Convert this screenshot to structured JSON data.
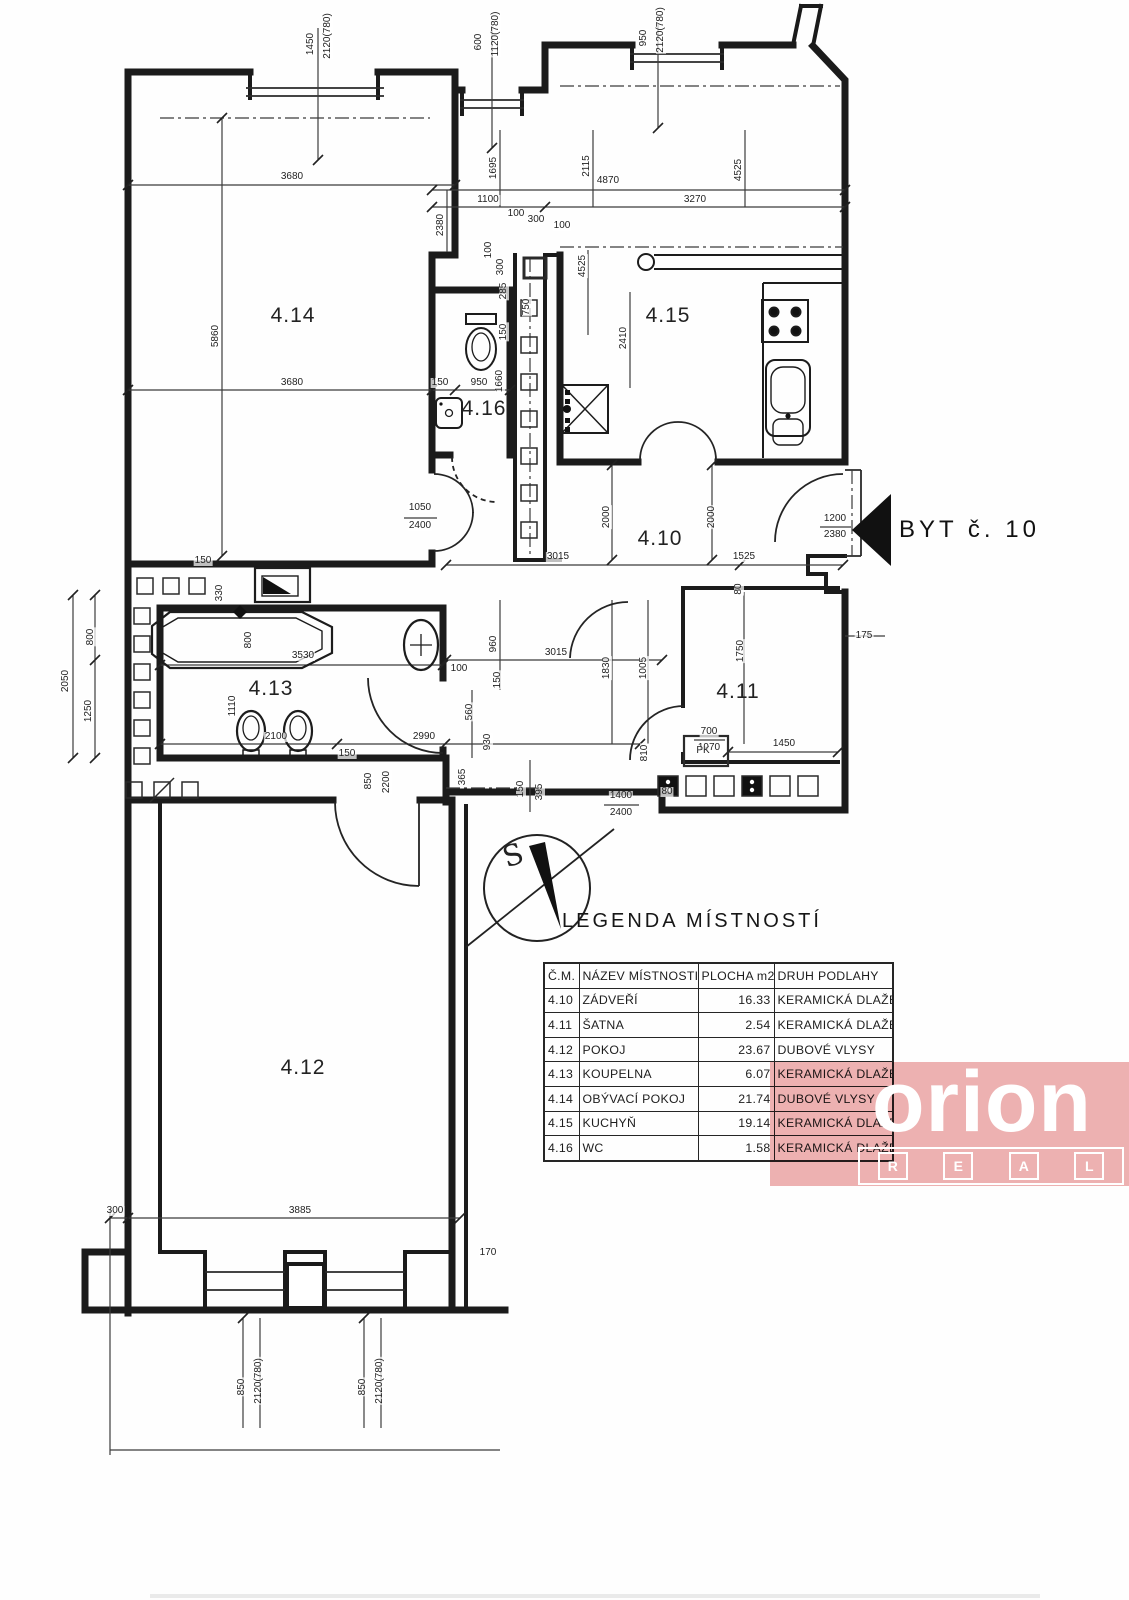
{
  "entrance": {
    "label": "BYT č. 10",
    "door_dims": "1200/2380"
  },
  "compass": {
    "north_letter": "S"
  },
  "legend": {
    "title": "LEGENDA MÍSTNOSTÍ",
    "headers": [
      "Č.M.",
      "NÁZEV MÍSTNOSTI",
      "PLOCHA m2",
      "DRUH PODLAHY"
    ],
    "rows": [
      [
        "4.10",
        "ZÁDVEŘÍ",
        "16.33",
        "KERAMICKÁ DLAŽBA"
      ],
      [
        "4.11",
        "ŠATNA",
        "2.54",
        "KERAMICKÁ DLAŽBA"
      ],
      [
        "4.12",
        "POKOJ",
        "23.67",
        "DUBOVÉ VLYSY"
      ],
      [
        "4.13",
        "KOUPELNA",
        "6.07",
        "KERAMICKÁ DLAŽBA"
      ],
      [
        "4.14",
        "OBÝVACÍ POKOJ",
        "21.74",
        "DUBOVÉ VLYSY"
      ],
      [
        "4.15",
        "KUCHYŇ",
        "19.14",
        "KERAMICKÁ DLAŽBA"
      ],
      [
        "4.16",
        "WC",
        "1.58",
        "KERAMICKÁ DLAŽBA"
      ]
    ]
  },
  "watermark": {
    "brand": "orion",
    "sub_letters": [
      "R",
      "E",
      "A",
      "L"
    ],
    "color": "#eeb2b2"
  },
  "plan": {
    "rooms": [
      {
        "id": "4.14",
        "x": 293,
        "y": 316
      },
      {
        "id": "4.15",
        "x": 668,
        "y": 316
      },
      {
        "id": "4.16",
        "x": 484,
        "y": 409
      },
      {
        "id": "4.10",
        "x": 660,
        "y": 539
      },
      {
        "id": "4.11",
        "x": 738,
        "y": 692
      },
      {
        "id": "4.13",
        "x": 271,
        "y": 689
      },
      {
        "id": "4.12",
        "x": 303,
        "y": 1068
      }
    ],
    "dimensions": [
      {
        "t": "1450",
        "x": 311,
        "y": 44,
        "r": 1
      },
      {
        "t": "2120(780)",
        "x": 328,
        "y": 36,
        "r": 1
      },
      {
        "t": "600",
        "x": 479,
        "y": 42,
        "r": 1
      },
      {
        "t": "1120(780)",
        "x": 496,
        "y": 34,
        "r": 1
      },
      {
        "t": "950",
        "x": 644,
        "y": 38,
        "r": 1
      },
      {
        "t": "2120(780)",
        "x": 661,
        "y": 30,
        "r": 1
      },
      {
        "t": "3680",
        "x": 292,
        "y": 177,
        "r": 0
      },
      {
        "t": "4870",
        "x": 608,
        "y": 181,
        "r": 0
      },
      {
        "t": "1100",
        "x": 488,
        "y": 200,
        "r": 0
      },
      {
        "t": "3270",
        "x": 695,
        "y": 200,
        "r": 0
      },
      {
        "t": "100",
        "x": 516,
        "y": 214,
        "r": 0
      },
      {
        "t": "300",
        "x": 536,
        "y": 220,
        "r": 0
      },
      {
        "t": "100",
        "x": 562,
        "y": 226,
        "r": 0
      },
      {
        "t": "2380",
        "x": 441,
        "y": 225,
        "r": 1
      },
      {
        "t": "1695",
        "x": 494,
        "y": 168,
        "r": 1
      },
      {
        "t": "2115",
        "x": 587,
        "y": 166,
        "r": 1
      },
      {
        "t": "4525",
        "x": 739,
        "y": 170,
        "r": 1
      },
      {
        "t": "5860",
        "x": 216,
        "y": 336,
        "r": 1
      },
      {
        "t": "3680",
        "x": 292,
        "y": 383,
        "r": 0
      },
      {
        "t": "150",
        "x": 440,
        "y": 383,
        "r": 0
      },
      {
        "t": "950",
        "x": 479,
        "y": 383,
        "r": 0
      },
      {
        "t": "1660",
        "x": 500,
        "y": 381,
        "r": 1
      },
      {
        "t": "100",
        "x": 489,
        "y": 250,
        "r": 1
      },
      {
        "t": "300",
        "x": 501,
        "y": 267,
        "r": 1
      },
      {
        "t": "285",
        "x": 504,
        "y": 291,
        "r": 1
      },
      {
        "t": "750",
        "x": 527,
        "y": 307,
        "r": 1
      },
      {
        "t": "150",
        "x": 504,
        "y": 332,
        "r": 1
      },
      {
        "t": "4525",
        "x": 583,
        "y": 266,
        "r": 1
      },
      {
        "t": "2410",
        "x": 624,
        "y": 338,
        "r": 1
      },
      {
        "t": "1050",
        "x": 420,
        "y": 508,
        "r": 0
      },
      {
        "t": "2400",
        "x": 420,
        "y": 526,
        "r": 0
      },
      {
        "t": "1200",
        "x": 835,
        "y": 519,
        "r": 0
      },
      {
        "t": "2380",
        "x": 835,
        "y": 535,
        "r": 0
      },
      {
        "t": "3015",
        "x": 558,
        "y": 557,
        "r": 0
      },
      {
        "t": "2000",
        "x": 607,
        "y": 517,
        "r": 1
      },
      {
        "t": "2000",
        "x": 712,
        "y": 517,
        "r": 1
      },
      {
        "t": "1525",
        "x": 744,
        "y": 557,
        "r": 0
      },
      {
        "t": "3015",
        "x": 556,
        "y": 653,
        "r": 0
      },
      {
        "t": "1830",
        "x": 607,
        "y": 668,
        "r": 1
      },
      {
        "t": "1005",
        "x": 644,
        "y": 668,
        "r": 1
      },
      {
        "t": "960",
        "x": 494,
        "y": 644,
        "r": 1
      },
      {
        "t": "100",
        "x": 459,
        "y": 669,
        "r": 0
      },
      {
        "t": "150",
        "x": 498,
        "y": 680,
        "r": 1
      },
      {
        "t": "560",
        "x": 470,
        "y": 712,
        "r": 1
      },
      {
        "t": "930",
        "x": 488,
        "y": 742,
        "r": 1
      },
      {
        "t": "365",
        "x": 463,
        "y": 777,
        "r": 1
      },
      {
        "t": "150",
        "x": 521,
        "y": 789,
        "r": 1
      },
      {
        "t": "395",
        "x": 540,
        "y": 792,
        "r": 1
      },
      {
        "t": "1750",
        "x": 741,
        "y": 651,
        "r": 1
      },
      {
        "t": "80",
        "x": 739,
        "y": 589,
        "r": 1
      },
      {
        "t": "175",
        "x": 864,
        "y": 636,
        "r": 0
      },
      {
        "t": "700",
        "x": 709,
        "y": 732,
        "r": 0
      },
      {
        "t": "1970",
        "x": 709,
        "y": 748,
        "r": 0
      },
      {
        "t": "810",
        "x": 645,
        "y": 753,
        "r": 1
      },
      {
        "t": "1400",
        "x": 621,
        "y": 796,
        "r": 0
      },
      {
        "t": "2400",
        "x": 621,
        "y": 813,
        "r": 0
      },
      {
        "t": "80",
        "x": 667,
        "y": 792,
        "r": 0
      },
      {
        "t": "PK",
        "x": 703,
        "y": 751,
        "r": 0
      },
      {
        "t": "1450",
        "x": 784,
        "y": 744,
        "r": 0
      },
      {
        "t": "330",
        "x": 220,
        "y": 593,
        "r": 1
      },
      {
        "t": "800",
        "x": 249,
        "y": 640,
        "r": 1
      },
      {
        "t": "3530",
        "x": 303,
        "y": 656,
        "r": 0
      },
      {
        "t": "1110",
        "x": 233,
        "y": 706,
        "r": 1
      },
      {
        "t": "2100",
        "x": 276,
        "y": 737,
        "r": 0
      },
      {
        "t": "2990",
        "x": 424,
        "y": 737,
        "r": 0
      },
      {
        "t": "150",
        "x": 347,
        "y": 754,
        "r": 0
      },
      {
        "t": "2050",
        "x": 66,
        "y": 681,
        "r": 1
      },
      {
        "t": "800",
        "x": 91,
        "y": 637,
        "r": 1
      },
      {
        "t": "1250",
        "x": 89,
        "y": 711,
        "r": 1
      },
      {
        "t": "150",
        "x": 203,
        "y": 561,
        "r": 0
      },
      {
        "t": "850",
        "x": 369,
        "y": 781,
        "r": 1
      },
      {
        "t": "2200",
        "x": 387,
        "y": 782,
        "r": 1
      },
      {
        "t": "300",
        "x": 115,
        "y": 1211,
        "r": 0
      },
      {
        "t": "3885",
        "x": 300,
        "y": 1211,
        "r": 0
      },
      {
        "t": "170",
        "x": 488,
        "y": 1253,
        "r": 0
      },
      {
        "t": "850",
        "x": 242,
        "y": 1387,
        "r": 1
      },
      {
        "t": "2120(780)",
        "x": 259,
        "y": 1381,
        "r": 1
      },
      {
        "t": "850",
        "x": 363,
        "y": 1387,
        "r": 1
      },
      {
        "t": "2120(780)",
        "x": 380,
        "y": 1381,
        "r": 1
      }
    ]
  }
}
